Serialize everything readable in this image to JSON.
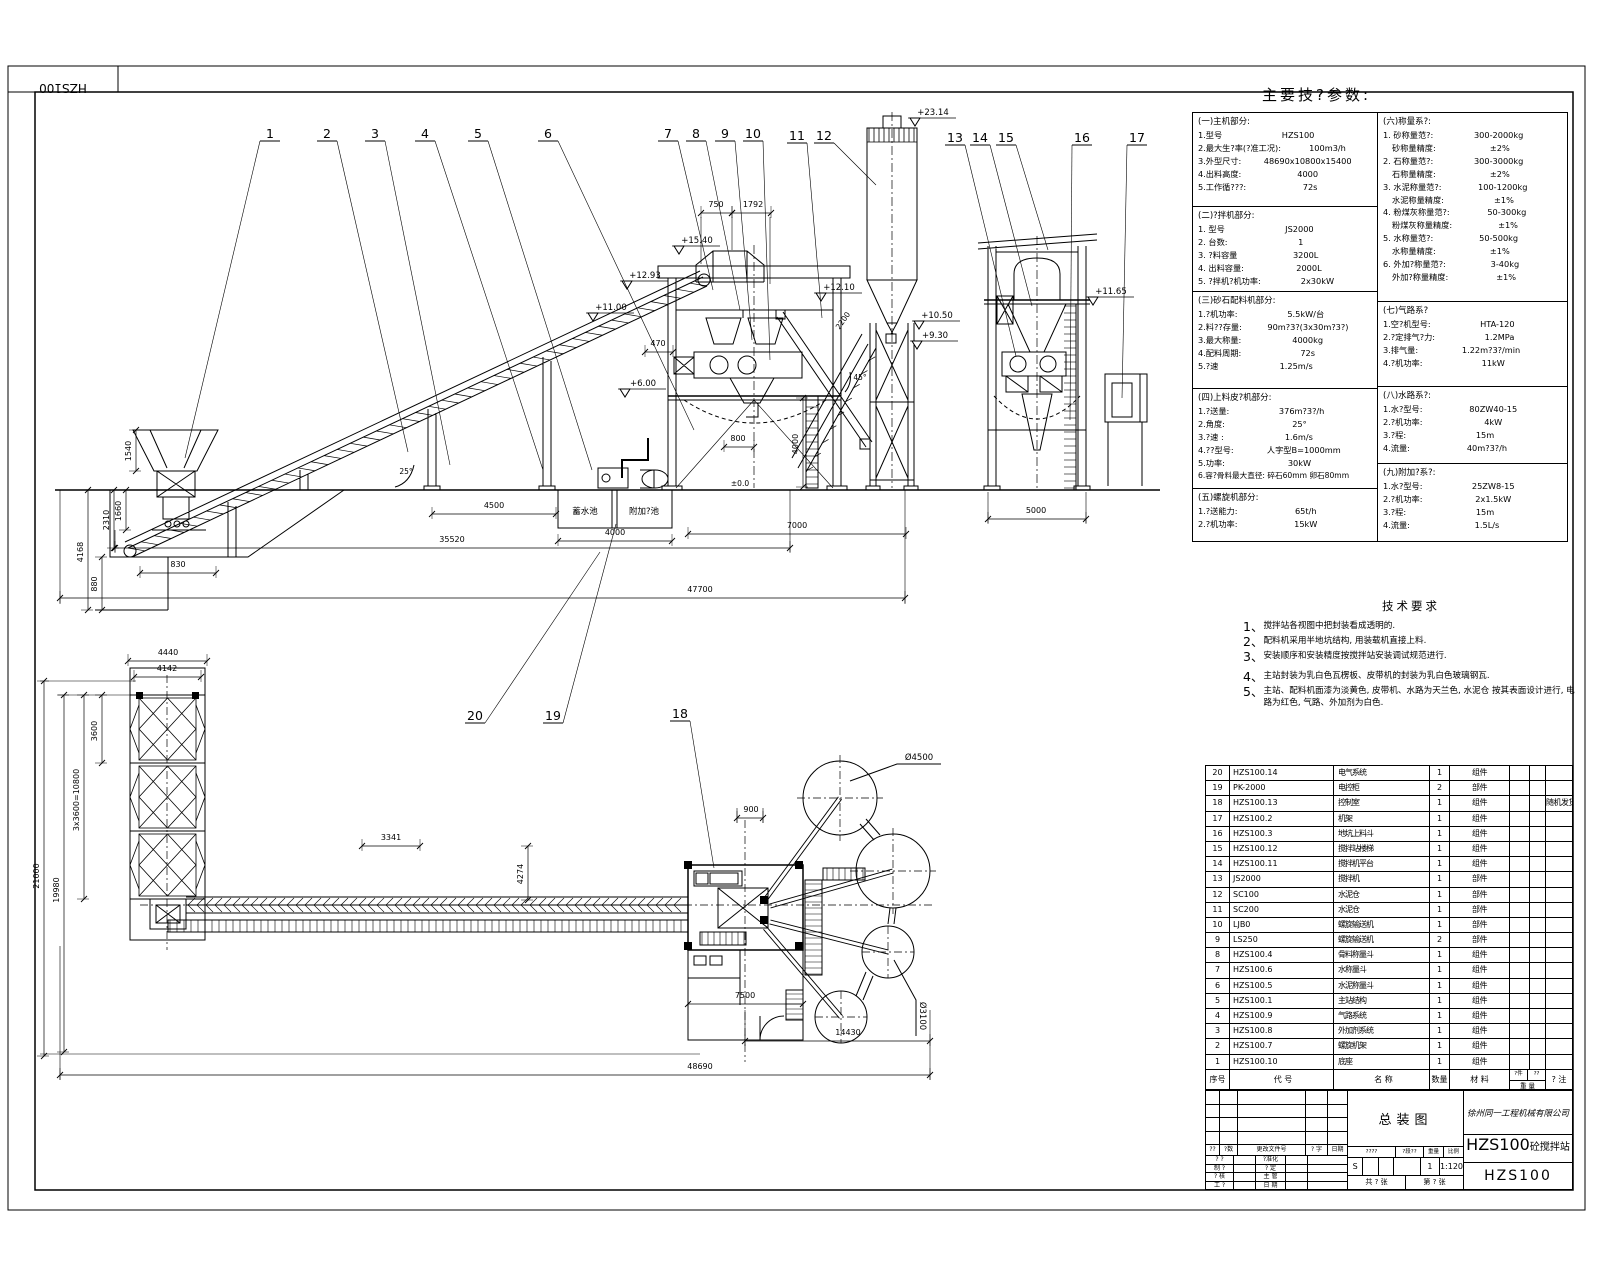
{
  "sheet": {
    "corner_code": "HZS100",
    "main_title": "主要技?参数:"
  },
  "params_table": {
    "left_sections": [
      {
        "header": "(一)主机部分:",
        "rows": [
          [
            "1.型号",
            "HZS100"
          ],
          [
            "2.最大生?率(?准工况):",
            "100m3/h"
          ],
          [
            "3.外型尺寸:",
            "48690x10800x15400"
          ],
          [
            "4.出料高度:",
            "4000"
          ],
          [
            "5.工作循???:",
            "72s"
          ]
        ]
      },
      {
        "header": "(二)?拌机部分:",
        "rows": [
          [
            "1. 型号",
            "JS2000"
          ],
          [
            "2. 台数:",
            "1"
          ],
          [
            "3. ?料容量",
            "3200L"
          ],
          [
            "4. 出料容量:",
            "2000L"
          ],
          [
            "5. ?拌机?机功率:",
            "2x30kW"
          ]
        ]
      },
      {
        "header": "(三)砂石配料机部分:",
        "rows": [
          [
            "1.?机功率:",
            "5.5kW/台"
          ],
          [
            "2.料??存量:",
            "90m?3?(3x30m?3?)"
          ],
          [
            "3.最大称量:",
            "4000kg"
          ],
          [
            "4.配料周期:",
            "72s"
          ],
          [
            "5.?速",
            "1.25m/s"
          ]
        ]
      },
      {
        "header": "(四)上料皮?机部分:",
        "rows": [
          [
            "1.?送量:",
            "376m?3?/h"
          ],
          [
            "2.角度:",
            "25°"
          ],
          [
            "3.?速 :",
            "1.6m/s"
          ],
          [
            "4.??型号:",
            "人字型B=1000mm"
          ],
          [
            "5.功率:",
            "30kW"
          ],
          [
            "6.容?骨料最大直径: 碎石60mm 卵石80mm"
          ]
        ]
      },
      {
        "header": "(五)螺旋机部分:",
        "rows": [
          [
            "1.?送能力:",
            "65t/h"
          ],
          [
            "2.?机功率:",
            "15kW"
          ]
        ]
      }
    ],
    "right_sections": [
      {
        "header": "(六)称量系?:",
        "rows": [
          [
            "1. 砂称量范?:",
            "300-2000kg"
          ],
          [
            "  砂称量精度:",
            "±2%"
          ],
          [
            "2. 石称量范?:",
            "300-3000kg"
          ],
          [
            "  石称量精度:",
            "±2%"
          ],
          [
            "3. 水泥称量范?:",
            "100-1200kg"
          ],
          [
            "  水泥称量精度:",
            "±1%"
          ],
          [
            "4. 粉煤灰称量范?:",
            "50-300kg"
          ],
          [
            "  粉煤灰称量精度:",
            "±1%"
          ],
          [
            "5. 水称量范?:",
            "50-500kg"
          ],
          [
            "  水称量精度:",
            "±1%"
          ],
          [
            "6. 外加?称量范?:",
            "3-40kg"
          ],
          [
            "  外加?称量精度:",
            "±1%"
          ]
        ]
      },
      {
        "header": "(七)气路系?",
        "rows": [
          [
            "1.空?机型号:",
            "HTA-120"
          ],
          [
            "2.?定排气?力:",
            "1.2MPa"
          ],
          [
            "3.排气量:",
            "1.22m?3?/min"
          ],
          [
            "4.?机功率:",
            "11kW"
          ]
        ]
      },
      {
        "header": "(八)水路系?:",
        "rows": [
          [
            "1.水?型号:",
            "80ZW40-15"
          ],
          [
            "2.?机功率:",
            "4kW"
          ],
          [
            "3.?程:",
            "15m"
          ],
          [
            "4.流量:",
            "40m?3?/h"
          ]
        ]
      },
      {
        "header": "(九)附加?系?:",
        "rows": [
          [
            "1.水?型号:",
            "25ZW8-15"
          ],
          [
            "2.?机功率:",
            "2x1.5kW"
          ],
          [
            "3.?程:",
            "15m"
          ],
          [
            "4.流量:",
            "1.5L/s"
          ]
        ]
      }
    ]
  },
  "tech_notes": {
    "title": "技术要求",
    "items": [
      {
        "num": "1、",
        "text": "搅拌站各视图中把封装看成透明的.",
        "gap": false
      },
      {
        "num": "2、",
        "text": "配料机采用半地坑结构, 用装载机直接上料.",
        "gap": false
      },
      {
        "num": "3、",
        "text": "安装顺序和安装精度按搅拌站安装调试规范进行.",
        "gap": false
      },
      {
        "num": "4、",
        "text": "主站封装为乳白色瓦楞板、皮带机的封装为乳白色玻璃钢瓦.",
        "gap": true
      },
      {
        "num": "5、",
        "text": "主站、配料机面漆为淡黄色, 皮带机、水路为天兰色, 水泥仓 按其表面设计进行, 电路为红色, 气路、外加剂为白色.",
        "gap": false
      }
    ]
  },
  "bom": {
    "headers": {
      "no": "序号",
      "code": "代      号",
      "name": "名      称",
      "qty": "数量",
      "mat": "材    料",
      "w1": "?件",
      "w2": "??",
      "w": "重 量",
      "remark": "? 注"
    },
    "rows": [
      {
        "no": "20",
        "code": "HZS100.14",
        "name": "电气系统",
        "qty": "1",
        "mat": "组件",
        "remark": ""
      },
      {
        "no": "19",
        "code": "PK-2000",
        "name": "电控柜",
        "qty": "2",
        "mat": "部件",
        "remark": ""
      },
      {
        "no": "18",
        "code": "HZS100.13",
        "name": "控制室",
        "qty": "1",
        "mat": "组件",
        "remark": "随机发货"
      },
      {
        "no": "17",
        "code": "HZS100.2",
        "name": "机架",
        "qty": "1",
        "mat": "组件",
        "remark": ""
      },
      {
        "no": "16",
        "code": "HZS100.3",
        "name": "地坑上料斗",
        "qty": "1",
        "mat": "组件",
        "remark": ""
      },
      {
        "no": "15",
        "code": "HZS100.12",
        "name": "搅拌站楼梯",
        "qty": "1",
        "mat": "组件",
        "remark": ""
      },
      {
        "no": "14",
        "code": "HZS100.11",
        "name": "搅拌机平台",
        "qty": "1",
        "mat": "组件",
        "remark": ""
      },
      {
        "no": "13",
        "code": "JS2000",
        "name": "搅拌机",
        "qty": "1",
        "mat": "部件",
        "remark": ""
      },
      {
        "no": "12",
        "code": "SC100",
        "name": "水泥仓",
        "qty": "1",
        "mat": "部件",
        "remark": ""
      },
      {
        "no": "11",
        "code": "SC200",
        "name": "水泥仓",
        "qty": "1",
        "mat": "部件",
        "remark": ""
      },
      {
        "no": "10",
        "code": "LJB0",
        "name": "螺旋输送机",
        "qty": "1",
        "mat": "部件",
        "remark": ""
      },
      {
        "no": "9",
        "code": "LS250",
        "name": "螺旋输送机",
        "qty": "2",
        "mat": "部件",
        "remark": ""
      },
      {
        "no": "8",
        "code": "HZS100.4",
        "name": "骨料称量斗",
        "qty": "1",
        "mat": "组件",
        "remark": ""
      },
      {
        "no": "7",
        "code": "HZS100.6",
        "name": "水称量斗",
        "qty": "1",
        "mat": "组件",
        "remark": ""
      },
      {
        "no": "6",
        "code": "HZS100.5",
        "name": "水泥称量斗",
        "qty": "1",
        "mat": "组件",
        "remark": ""
      },
      {
        "no": "5",
        "code": "HZS100.1",
        "name": "主站结构",
        "qty": "1",
        "mat": "组件",
        "remark": ""
      },
      {
        "no": "4",
        "code": "HZS100.9",
        "name": "气路系统",
        "qty": "1",
        "mat": "组件",
        "remark": ""
      },
      {
        "no": "3",
        "code": "HZS100.8",
        "name": "外加剂系统",
        "qty": "1",
        "mat": "组件",
        "remark": ""
      },
      {
        "no": "2",
        "code": "HZS100.7",
        "name": "螺旋机架",
        "qty": "1",
        "mat": "组件",
        "remark": ""
      },
      {
        "no": "1",
        "code": "HZS100.10",
        "name": "底座",
        "qty": "1",
        "mat": "组件",
        "remark": ""
      }
    ]
  },
  "title_block": {
    "company": "徐州同一工程机械有限公司",
    "drawing_title": "总装图",
    "product_big": "HZS100",
    "product_small": "砼搅拌站",
    "code": "HZS100",
    "rev_strip": [
      "??",
      "?数",
      "更改文件号",
      "? 字",
      "日期"
    ],
    "sign_rows": [
      [
        "? ?",
        "?准化"
      ],
      [
        "制 ?",
        "? 定"
      ],
      [
        "? 核",
        "主 管"
      ],
      [
        "工 ?",
        "日 期"
      ]
    ],
    "mid_header": [
      "????",
      "?段??",
      "重量",
      "比例"
    ],
    "stage": "S",
    "weight": "1",
    "scale": "1:120",
    "sheet_total": "共 ? 张",
    "sheet_no": "第 ? 张"
  },
  "annotations": {
    "balloons": [
      {
        "n": "1",
        "x": 270,
        "y": 138,
        "ex": 185,
        "ey": 458
      },
      {
        "n": "2",
        "x": 327,
        "y": 138,
        "ex": 408,
        "ey": 452
      },
      {
        "n": "3",
        "x": 375,
        "y": 138,
        "ex": 450,
        "ey": 465
      },
      {
        "n": "4",
        "x": 425,
        "y": 138,
        "ex": 543,
        "ey": 470
      },
      {
        "n": "5",
        "x": 478,
        "y": 138,
        "ex": 592,
        "ey": 470
      },
      {
        "n": "6",
        "x": 548,
        "y": 138,
        "ex": 694,
        "ey": 430
      },
      {
        "n": "7",
        "x": 668,
        "y": 138,
        "ex": 713,
        "ey": 290
      },
      {
        "n": "8",
        "x": 696,
        "y": 138,
        "ex": 740,
        "ey": 310
      },
      {
        "n": "9",
        "x": 725,
        "y": 138,
        "ex": 752,
        "ey": 340
      },
      {
        "n": "10",
        "x": 753,
        "y": 138,
        "ex": 770,
        "ey": 360
      },
      {
        "n": "11",
        "x": 797,
        "y": 140,
        "ex": 822,
        "ey": 318
      },
      {
        "n": "12",
        "x": 824,
        "y": 140,
        "ex": 876,
        "ey": 185
      },
      {
        "n": "13",
        "x": 955,
        "y": 142,
        "ex": 1016,
        "ey": 356
      },
      {
        "n": "14",
        "x": 980,
        "y": 142,
        "ex": 1032,
        "ey": 306
      },
      {
        "n": "15",
        "x": 1006,
        "y": 142,
        "ex": 1048,
        "ey": 250
      },
      {
        "n": "16",
        "x": 1082,
        "y": 142,
        "ex": 1070,
        "ey": 420
      },
      {
        "n": "17",
        "x": 1137,
        "y": 142,
        "ex": 1122,
        "ey": 398
      },
      {
        "n": "18",
        "x": 680,
        "y": 718,
        "ex": 714,
        "ey": 868
      },
      {
        "n": "19",
        "x": 553,
        "y": 720,
        "ex": 616,
        "ey": 524
      },
      {
        "n": "20",
        "x": 475,
        "y": 720,
        "ex": 600,
        "ey": 552
      }
    ],
    "elev_marks": [
      {
        "t": "+23.14",
        "x": 908,
        "y": 118
      },
      {
        "t": "+15.40",
        "x": 672,
        "y": 246
      },
      {
        "t": "+12.93",
        "x": 620,
        "y": 281
      },
      {
        "t": "+11.00",
        "x": 586,
        "y": 313
      },
      {
        "t": "+12.10",
        "x": 814,
        "y": 293
      },
      {
        "t": "+10.50",
        "x": 912,
        "y": 321
      },
      {
        "t": "+9.30",
        "x": 910,
        "y": 341
      },
      {
        "t": "+6.00",
        "x": 618,
        "y": 389
      },
      {
        "t": "+11.65",
        "x": 1086,
        "y": 297
      }
    ],
    "dims": [
      {
        "t": "47700",
        "x1": 60,
        "y1": 598,
        "x2": 905,
        "y2": 598,
        "tx": 700,
        "ty": 592
      },
      {
        "t": "35520",
        "x1": 115,
        "y1": 548,
        "x2": 790,
        "y2": 548,
        "tx": 452,
        "ty": 542
      },
      {
        "t": "830",
        "x1": 140,
        "y1": 573,
        "x2": 216,
        "y2": 573,
        "tx": 178,
        "ty": 567
      },
      {
        "t": "880",
        "x1": 102,
        "y1": 557,
        "x2": 102,
        "y2": 610,
        "tx": 97,
        "ty": 584,
        "v": true
      },
      {
        "t": "4168",
        "x1": 88,
        "y1": 490,
        "x2": 88,
        "y2": 610,
        "tx": 83,
        "ty": 552,
        "v": true
      },
      {
        "t": "2310",
        "x1": 114,
        "y1": 490,
        "x2": 114,
        "y2": 548,
        "tx": 109,
        "ty": 520,
        "v": true
      },
      {
        "t": "1660",
        "x1": 126,
        "y1": 490,
        "x2": 126,
        "y2": 530,
        "tx": 121,
        "ty": 511,
        "v": true
      },
      {
        "t": "1540",
        "x1": 136,
        "y1": 430,
        "x2": 136,
        "y2": 471,
        "tx": 131,
        "ty": 451,
        "v": true
      },
      {
        "t": "4500",
        "x1": 432,
        "y1": 514,
        "x2": 556,
        "y2": 514,
        "tx": 494,
        "ty": 508
      },
      {
        "t": "4000",
        "x1": 558,
        "y1": 541,
        "x2": 672,
        "y2": 541,
        "tx": 615,
        "ty": 535
      },
      {
        "t": "7000",
        "x1": 688,
        "y1": 534,
        "x2": 906,
        "y2": 534,
        "tx": 797,
        "ty": 528
      },
      {
        "t": "750",
        "x1": 701,
        "y1": 213,
        "x2": 732,
        "y2": 213,
        "tx": 716,
        "ty": 207
      },
      {
        "t": "1792",
        "x1": 732,
        "y1": 213,
        "x2": 771,
        "y2": 213,
        "tx": 753,
        "ty": 207
      },
      {
        "t": "470",
        "x1": 645,
        "y1": 352,
        "x2": 673,
        "y2": 352,
        "tx": 658,
        "ty": 346
      },
      {
        "t": "800",
        "x1": 724,
        "y1": 447,
        "x2": 754,
        "y2": 447,
        "tx": 738,
        "ty": 441
      },
      {
        "t": "4000",
        "x1": 803,
        "y1": 398,
        "x2": 803,
        "y2": 487,
        "tx": 798,
        "ty": 444,
        "v": true
      },
      {
        "t": "5000",
        "x1": 988,
        "y1": 519,
        "x2": 1086,
        "y2": 519,
        "tx": 1036,
        "ty": 513
      },
      {
        "t": "48690",
        "x1": 60,
        "y1": 1075,
        "x2": 930,
        "y2": 1075,
        "tx": 700,
        "ty": 1069
      },
      {
        "t": "14430",
        "x1": 745,
        "y1": 1041,
        "x2": 930,
        "y2": 1041,
        "tx": 848,
        "ty": 1035
      },
      {
        "t": "7500",
        "x1": 688,
        "y1": 1004,
        "x2": 803,
        "y2": 1004,
        "tx": 745,
        "ty": 998
      },
      {
        "t": "900",
        "x1": 737,
        "y1": 818,
        "x2": 763,
        "y2": 818,
        "tx": 751,
        "ty": 812
      },
      {
        "t": "4440",
        "x1": 128,
        "y1": 661,
        "x2": 207,
        "y2": 661,
        "tx": 168,
        "ty": 655
      },
      {
        "t": "4142",
        "x1": 134,
        "y1": 677,
        "x2": 201,
        "y2": 677,
        "tx": 167,
        "ty": 671
      },
      {
        "t": "3600",
        "x1": 102,
        "y1": 695,
        "x2": 102,
        "y2": 763,
        "tx": 97,
        "ty": 731,
        "v": true
      },
      {
        "t": "3x3600=10800",
        "x1": 84,
        "y1": 695,
        "x2": 84,
        "y2": 899,
        "tx": 79,
        "ty": 800,
        "v": true
      },
      {
        "t": "19980",
        "x1": 64,
        "y1": 695,
        "x2": 64,
        "y2": 1052,
        "tx": 59,
        "ty": 890,
        "v": true
      },
      {
        "t": "21000",
        "x1": 44,
        "y1": 681,
        "x2": 44,
        "y2": 1056,
        "tx": 39,
        "ty": 876,
        "v": true
      },
      {
        "t": "3341",
        "x1": 362,
        "y1": 846,
        "x2": 420,
        "y2": 846,
        "tx": 391,
        "ty": 840
      },
      {
        "t": "4274",
        "x1": 528,
        "y1": 846,
        "x2": 528,
        "y2": 900,
        "tx": 523,
        "ty": 874,
        "v": true
      }
    ],
    "labels": [
      {
        "t": "蓄水池",
        "x": 585,
        "y": 514,
        "s": 8.5
      },
      {
        "t": "附加?池",
        "x": 644,
        "y": 514,
        "s": 8.5
      },
      {
        "t": "±0.0",
        "x": 740,
        "y": 486,
        "s": 7.5
      },
      {
        "t": "Ø4500",
        "x": 919,
        "y": 760,
        "s": 8.5
      },
      {
        "t": "Ø3100",
        "x": 920,
        "y": 1016,
        "s": 8.5,
        "r": 90
      },
      {
        "t": "25°",
        "x": 406,
        "y": 474,
        "s": 7.5
      },
      {
        "t": "45°",
        "x": 860,
        "y": 380,
        "s": 7.5
      },
      {
        "t": "2200",
        "x": 845,
        "y": 322,
        "s": 7.5,
        "r": -55
      }
    ]
  }
}
